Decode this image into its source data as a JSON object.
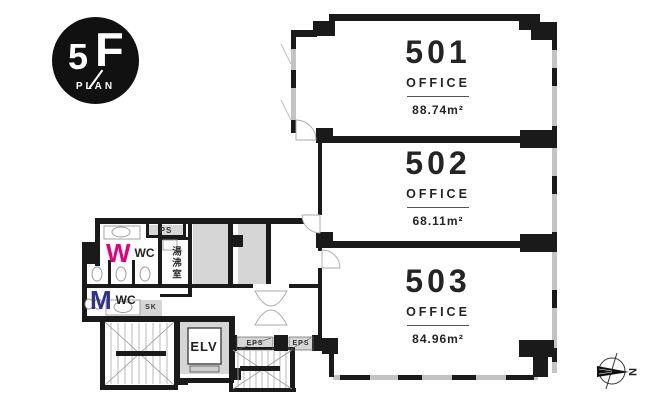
{
  "title": "5F floor plan",
  "badge": {
    "floor_number": "5",
    "floor_letter": "F",
    "plan_label": "PLAN"
  },
  "units": [
    {
      "number": "501",
      "type_label": "OFFICE",
      "area": "88.74m²"
    },
    {
      "number": "502",
      "type_label": "OFFICE",
      "area": "68.11m²"
    },
    {
      "number": "503",
      "type_label": "OFFICE",
      "area": "84.96m²"
    }
  ],
  "core": {
    "womens_wc_initial": "W",
    "womens_wc_label": "WC",
    "mens_wc_initial": "M",
    "mens_wc_label": "WC",
    "pipe_space_label": "PS",
    "kitchenette_label": "湯沸室",
    "slop_sink_label": "SK",
    "elevator_label": "ELV",
    "eps_left_label": "EPS",
    "eps_right_label": "EPS"
  },
  "compass": {
    "north_label": "N"
  },
  "colors": {
    "wall": "#1a1a1a",
    "window_band": "#c3c3c3",
    "service_room_fill": "#d6d6d6",
    "womens_accent": "#e5007f",
    "mens_accent": "#2e3192",
    "badge_bg": "#111111",
    "text": "#1f1f1f"
  }
}
